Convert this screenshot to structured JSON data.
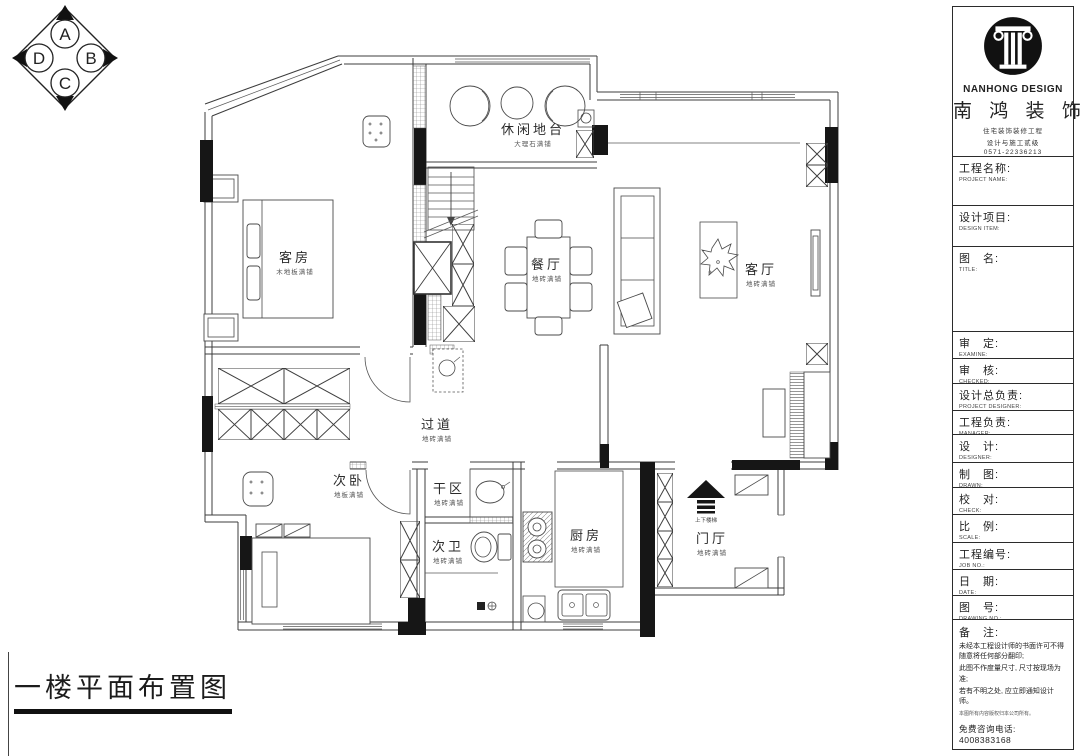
{
  "page": {
    "title": "一楼平面布置图"
  },
  "compass": {
    "top": "A",
    "right": "B",
    "bottom": "C",
    "left": "D"
  },
  "plan": {
    "rooms": [
      {
        "name": "客房",
        "finish": "木地板满铺"
      },
      {
        "name": "休闲地台",
        "finish": "大理石满铺"
      },
      {
        "name": "餐厅",
        "finish": "地砖满铺"
      },
      {
        "name": "客厅",
        "finish": "地砖满铺"
      },
      {
        "name": "过道",
        "finish": "地砖满铺"
      },
      {
        "name": "次卧",
        "finish": "地板满铺"
      },
      {
        "name": "干区",
        "finish": "地砖满铺"
      },
      {
        "name": "次卫",
        "finish": "地砖满铺"
      },
      {
        "name": "厨房",
        "finish": "地砖满铺"
      },
      {
        "name": "门厅",
        "finish": "地砖满铺"
      }
    ],
    "stair_note": "上下楼梯"
  },
  "title_block": {
    "brand_en": "NANHONG DESIGN",
    "brand_cn": "南 鸿 装 饰",
    "taglines": [
      "住宅装饰装修工程",
      "设计与施工贰级",
      "0571-22336213"
    ],
    "fields": [
      {
        "cn": "工程名称:",
        "en": "PROJECT NAME:"
      },
      {
        "cn": "设计项目:",
        "en": "DESIGN ITEM:"
      },
      {
        "cn": "图　名:",
        "en": "TITLE:"
      },
      {
        "cn": "审　定:",
        "en": "EXAMINE:"
      },
      {
        "cn": "审　核:",
        "en": "CHECKED:"
      },
      {
        "cn": "设计总负责:",
        "en": "PROJECT DESIGNER:"
      },
      {
        "cn": "工程负责:",
        "en": "MANAGER:"
      },
      {
        "cn": "设　计:",
        "en": "DESIGNER:"
      },
      {
        "cn": "制　图:",
        "en": "DRAWN:"
      },
      {
        "cn": "校　对:",
        "en": "CHECK:"
      },
      {
        "cn": "比　例:",
        "en": "SCALE:"
      },
      {
        "cn": "工程编号:",
        "en": "JOB NO.:"
      },
      {
        "cn": "日　期:",
        "en": "DATE:"
      },
      {
        "cn": "图　号:",
        "en": "DRAWING NO.:"
      }
    ],
    "notes": {
      "label": "备　注:",
      "lines": [
        "未经本工程设计师的书面许可不得随意将任何部分翻印;",
        "此图不作度量尺寸, 尺寸按现场为准;",
        "若有不明之处, 应立即通知设计师。"
      ],
      "tiny": "本图所有内容版权归本公司所有。",
      "phone": "免费咨询电话: 4008383168"
    }
  }
}
